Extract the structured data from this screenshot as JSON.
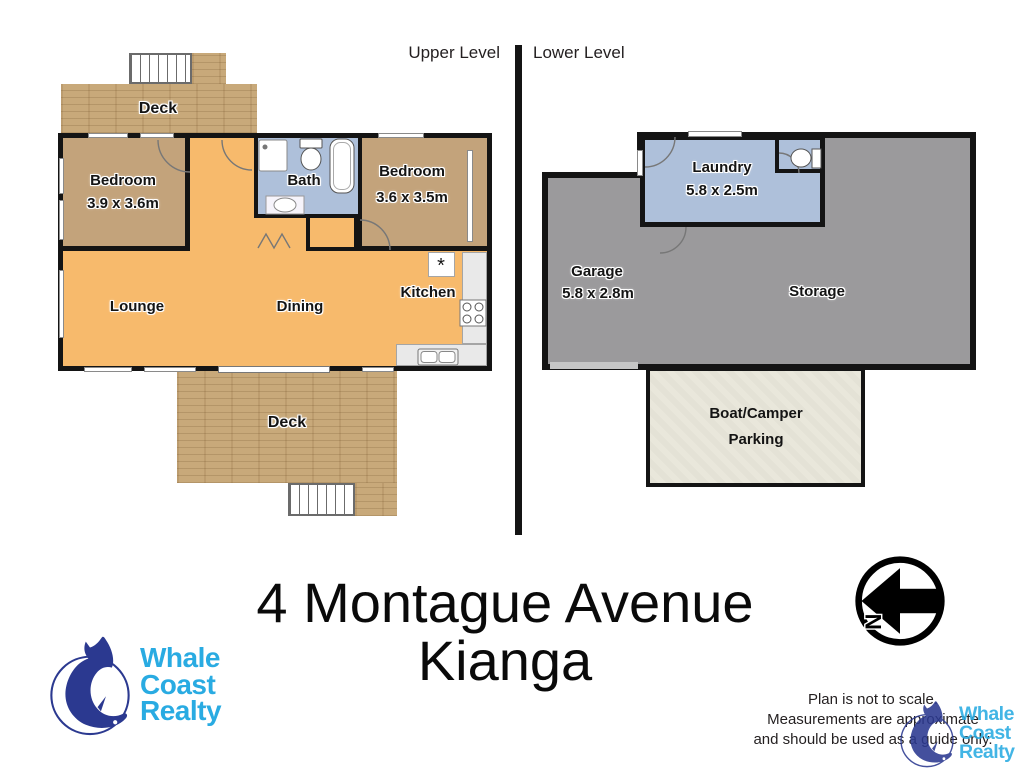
{
  "levels": {
    "upper": "Upper Level",
    "lower": "Lower Level"
  },
  "upper": {
    "deck_top": "Deck",
    "bedroom1": {
      "name": "Bedroom",
      "dims": "3.9 x 3.6m"
    },
    "bath": "Bath",
    "bedroom2": {
      "name": "Bedroom",
      "dims": "3.6 x 3.5m"
    },
    "lounge": "Lounge",
    "dining": "Dining",
    "kitchen": "Kitchen",
    "deck_bottom": "Deck",
    "appliance_marker": "*"
  },
  "lower": {
    "laundry": {
      "name": "Laundry",
      "dims": "5.8 x 2.5m"
    },
    "garage": {
      "name": "Garage",
      "dims": "5.8 x 2.8m"
    },
    "storage": "Storage",
    "parking": {
      "line1": "Boat/Camper",
      "line2": "Parking"
    }
  },
  "address": {
    "line1": "4 Montague Avenue",
    "line2": "Kianga"
  },
  "disclaimer": {
    "line1": "Plan is not to scale.",
    "line2": "Measurements are approximate",
    "line3": "and should be used as a guide only."
  },
  "logo": {
    "line1": "Whale",
    "line2": "Coast",
    "line3": "Realty"
  },
  "compass": {
    "north": "N"
  },
  "colors": {
    "wall": "#141414",
    "floor_orange": "#f7ba6c",
    "room_tan": "#c3a37b",
    "wet_blue": "#aec0da",
    "garage_gray": "#9b9a9c",
    "deck_wood": "#c8a97a",
    "parking_beige": "#e9e7db",
    "logo_blue": "#29abe2",
    "whale_navy": "#2b3990",
    "counter_gray": "#e9e9e9"
  }
}
